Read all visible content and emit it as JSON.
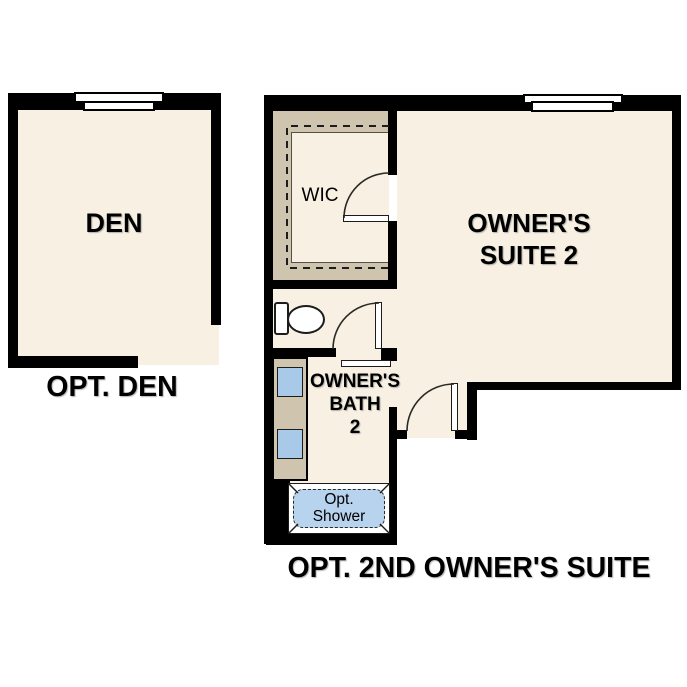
{
  "colors": {
    "wall": "#000000",
    "floor": "#f7f0e3",
    "closet_tan": "#cfc5ae",
    "sink_blue": "#a9c9e9",
    "shower_blue": "#b7d3ee",
    "text": "#000000",
    "background": "#ffffff"
  },
  "plans": {
    "den": {
      "room_label": "DEN",
      "caption": "OPT. DEN"
    },
    "owners_suite": {
      "wic_label": "WIC",
      "room_lines": [
        "OWNER'S",
        "SUITE 2"
      ],
      "bath_lines": [
        "OWNER'S",
        "BATH",
        "2"
      ],
      "shower_lines": [
        "Opt.",
        "Shower"
      ],
      "caption": "OPT. 2ND OWNER'S SUITE"
    }
  }
}
